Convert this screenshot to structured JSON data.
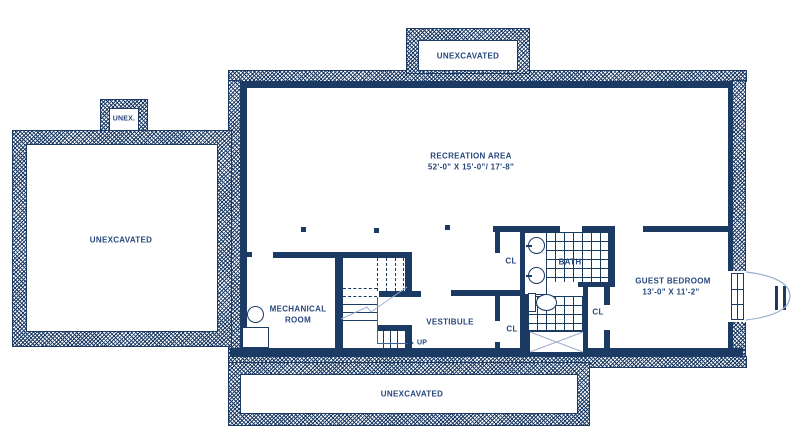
{
  "drawing": {
    "type": "basement floor plan",
    "colors": {
      "wall": "#1b3a64",
      "text": "#27477e",
      "light_line": "#9db0cd",
      "background": "#ffffff"
    }
  },
  "areas": {
    "unexcavated_top": {
      "label": "UNEXCAVATED"
    },
    "unex_bump": {
      "label": "UNEX."
    },
    "unexcavated_left": {
      "label": "UNEXCAVATED"
    },
    "unexcavated_bottom": {
      "label": "UNEXCAVATED"
    },
    "recreation": {
      "label": "RECREATION AREA",
      "dimensions": "52'-0\" X 15'-0\"/ 17'-8\""
    },
    "mechanical": {
      "label_line1": "MECHANICAL",
      "label_line2": "ROOM"
    },
    "vestibule": {
      "label": "VESTIBULE"
    },
    "bath": {
      "label": "BATH"
    },
    "guest_bedroom": {
      "label": "GUEST BEDROOM",
      "dimensions": "13'-0\" X 11'-2\""
    },
    "closet_top": {
      "label": "CL"
    },
    "closet_bottom": {
      "label": "CL"
    },
    "closet_guest": {
      "label": "CL"
    }
  },
  "stairs": {
    "direction_label": "UP"
  }
}
